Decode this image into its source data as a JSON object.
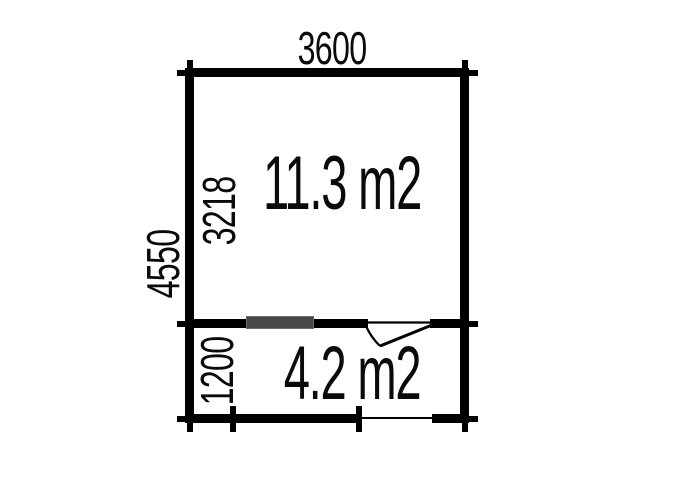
{
  "plan": {
    "overall": {
      "width_label": "3600",
      "height_label": "4550"
    },
    "rooms": [
      {
        "id": "room-1",
        "height_label": "3218",
        "area_label": "11.3 m2"
      },
      {
        "id": "room-2",
        "height_label": "1200",
        "area_label": "4.2 m2"
      }
    ],
    "features": {
      "window_icon": "dark-gray filled rectangle on dividing wall",
      "door_swing_icon": "door leaf with swing arc, hinged right, opening into lower room",
      "entrance_opening": "thin line gap in bottom wall"
    },
    "colors": {
      "wall": "#000000",
      "window_fill": "#474747",
      "window_border": "#6a6a6a",
      "background": "#ffffff",
      "text": "#0a0a0a"
    }
  }
}
